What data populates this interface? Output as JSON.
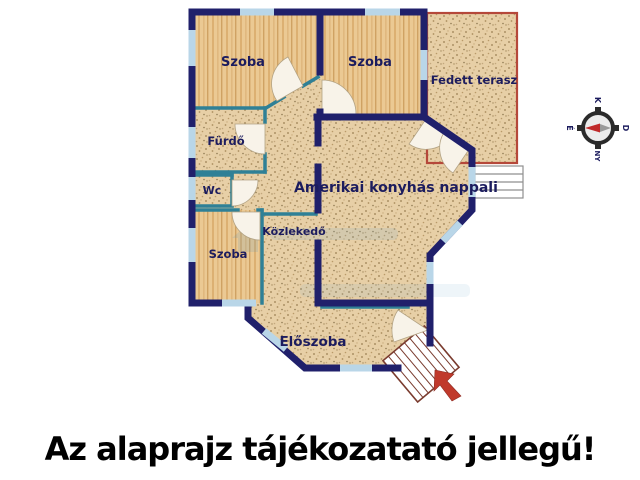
{
  "floorplan": {
    "rooms": {
      "szoba1": "Szoba",
      "szoba2": "Szoba",
      "terasz": "Fedett terasz",
      "furdo": "Fürdő",
      "wc": "Wc",
      "szoba3": "Szoba",
      "nappali": "Amerikai konyhás nappali",
      "kozlekedo": "Közlekedő",
      "eloszoba": "Előszoba"
    },
    "compass": {
      "top": "K",
      "right": "D",
      "bottom": "NY",
      "left": "É"
    },
    "colors": {
      "outer_wall": "#20206b",
      "interior_wall": "#2f8096",
      "window": "#b9d6e8",
      "wood_floor": "#ebc993",
      "stipple_floor": "#e7cfa6",
      "terrace_border": "#b5483a",
      "stairs_outline": "#7a3b2e",
      "arrow_red": "#c0392b",
      "label_text": "#1c1c5e",
      "caption_text": "#000000"
    }
  },
  "caption": {
    "text": "Az alaprajz tájékozatató jellegű!"
  }
}
